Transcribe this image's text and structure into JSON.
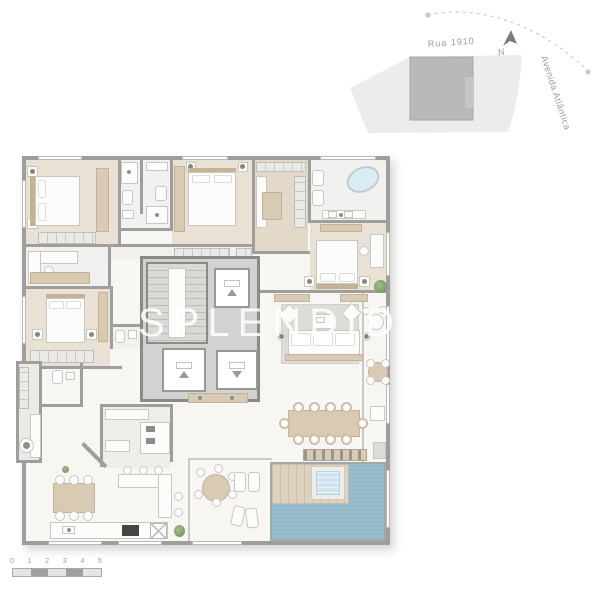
{
  "watermark": {
    "text": "SPLENDIDO"
  },
  "site_map": {
    "street_top": "Rua 1910",
    "street_right": "Avenida Atlântica",
    "north_label": "N"
  },
  "scale_bar": {
    "ticks": [
      "0",
      "1",
      "2",
      "3",
      "4",
      "5"
    ]
  },
  "colors": {
    "wall": "#9e9e9c",
    "core_wall": "#8a8a88",
    "core_floor": "#d2d2d0",
    "floor_wood": "#e8e1d4",
    "floor_wood_dark": "#e2d9c8",
    "floor_light": "#f1f1f0",
    "furn_white": "#fcfcfb",
    "furn_border": "#c7c7c3",
    "tan": "#d9cbb3",
    "tan_dark": "#c4b294",
    "pool": "#99bccd",
    "tub": "#cfe4ee",
    "deck": "#ddd2bf",
    "deck_line": "#cdbfa9",
    "green": "#7d9b67",
    "map_lot": "#ececec",
    "map_building": "#b9b9b9",
    "map_text": "#9a9a9a",
    "scale_light": "#e4e4e4",
    "scale_dark": "#a0a0a0",
    "watermark": "rgba(255,255,255,0.85)"
  }
}
